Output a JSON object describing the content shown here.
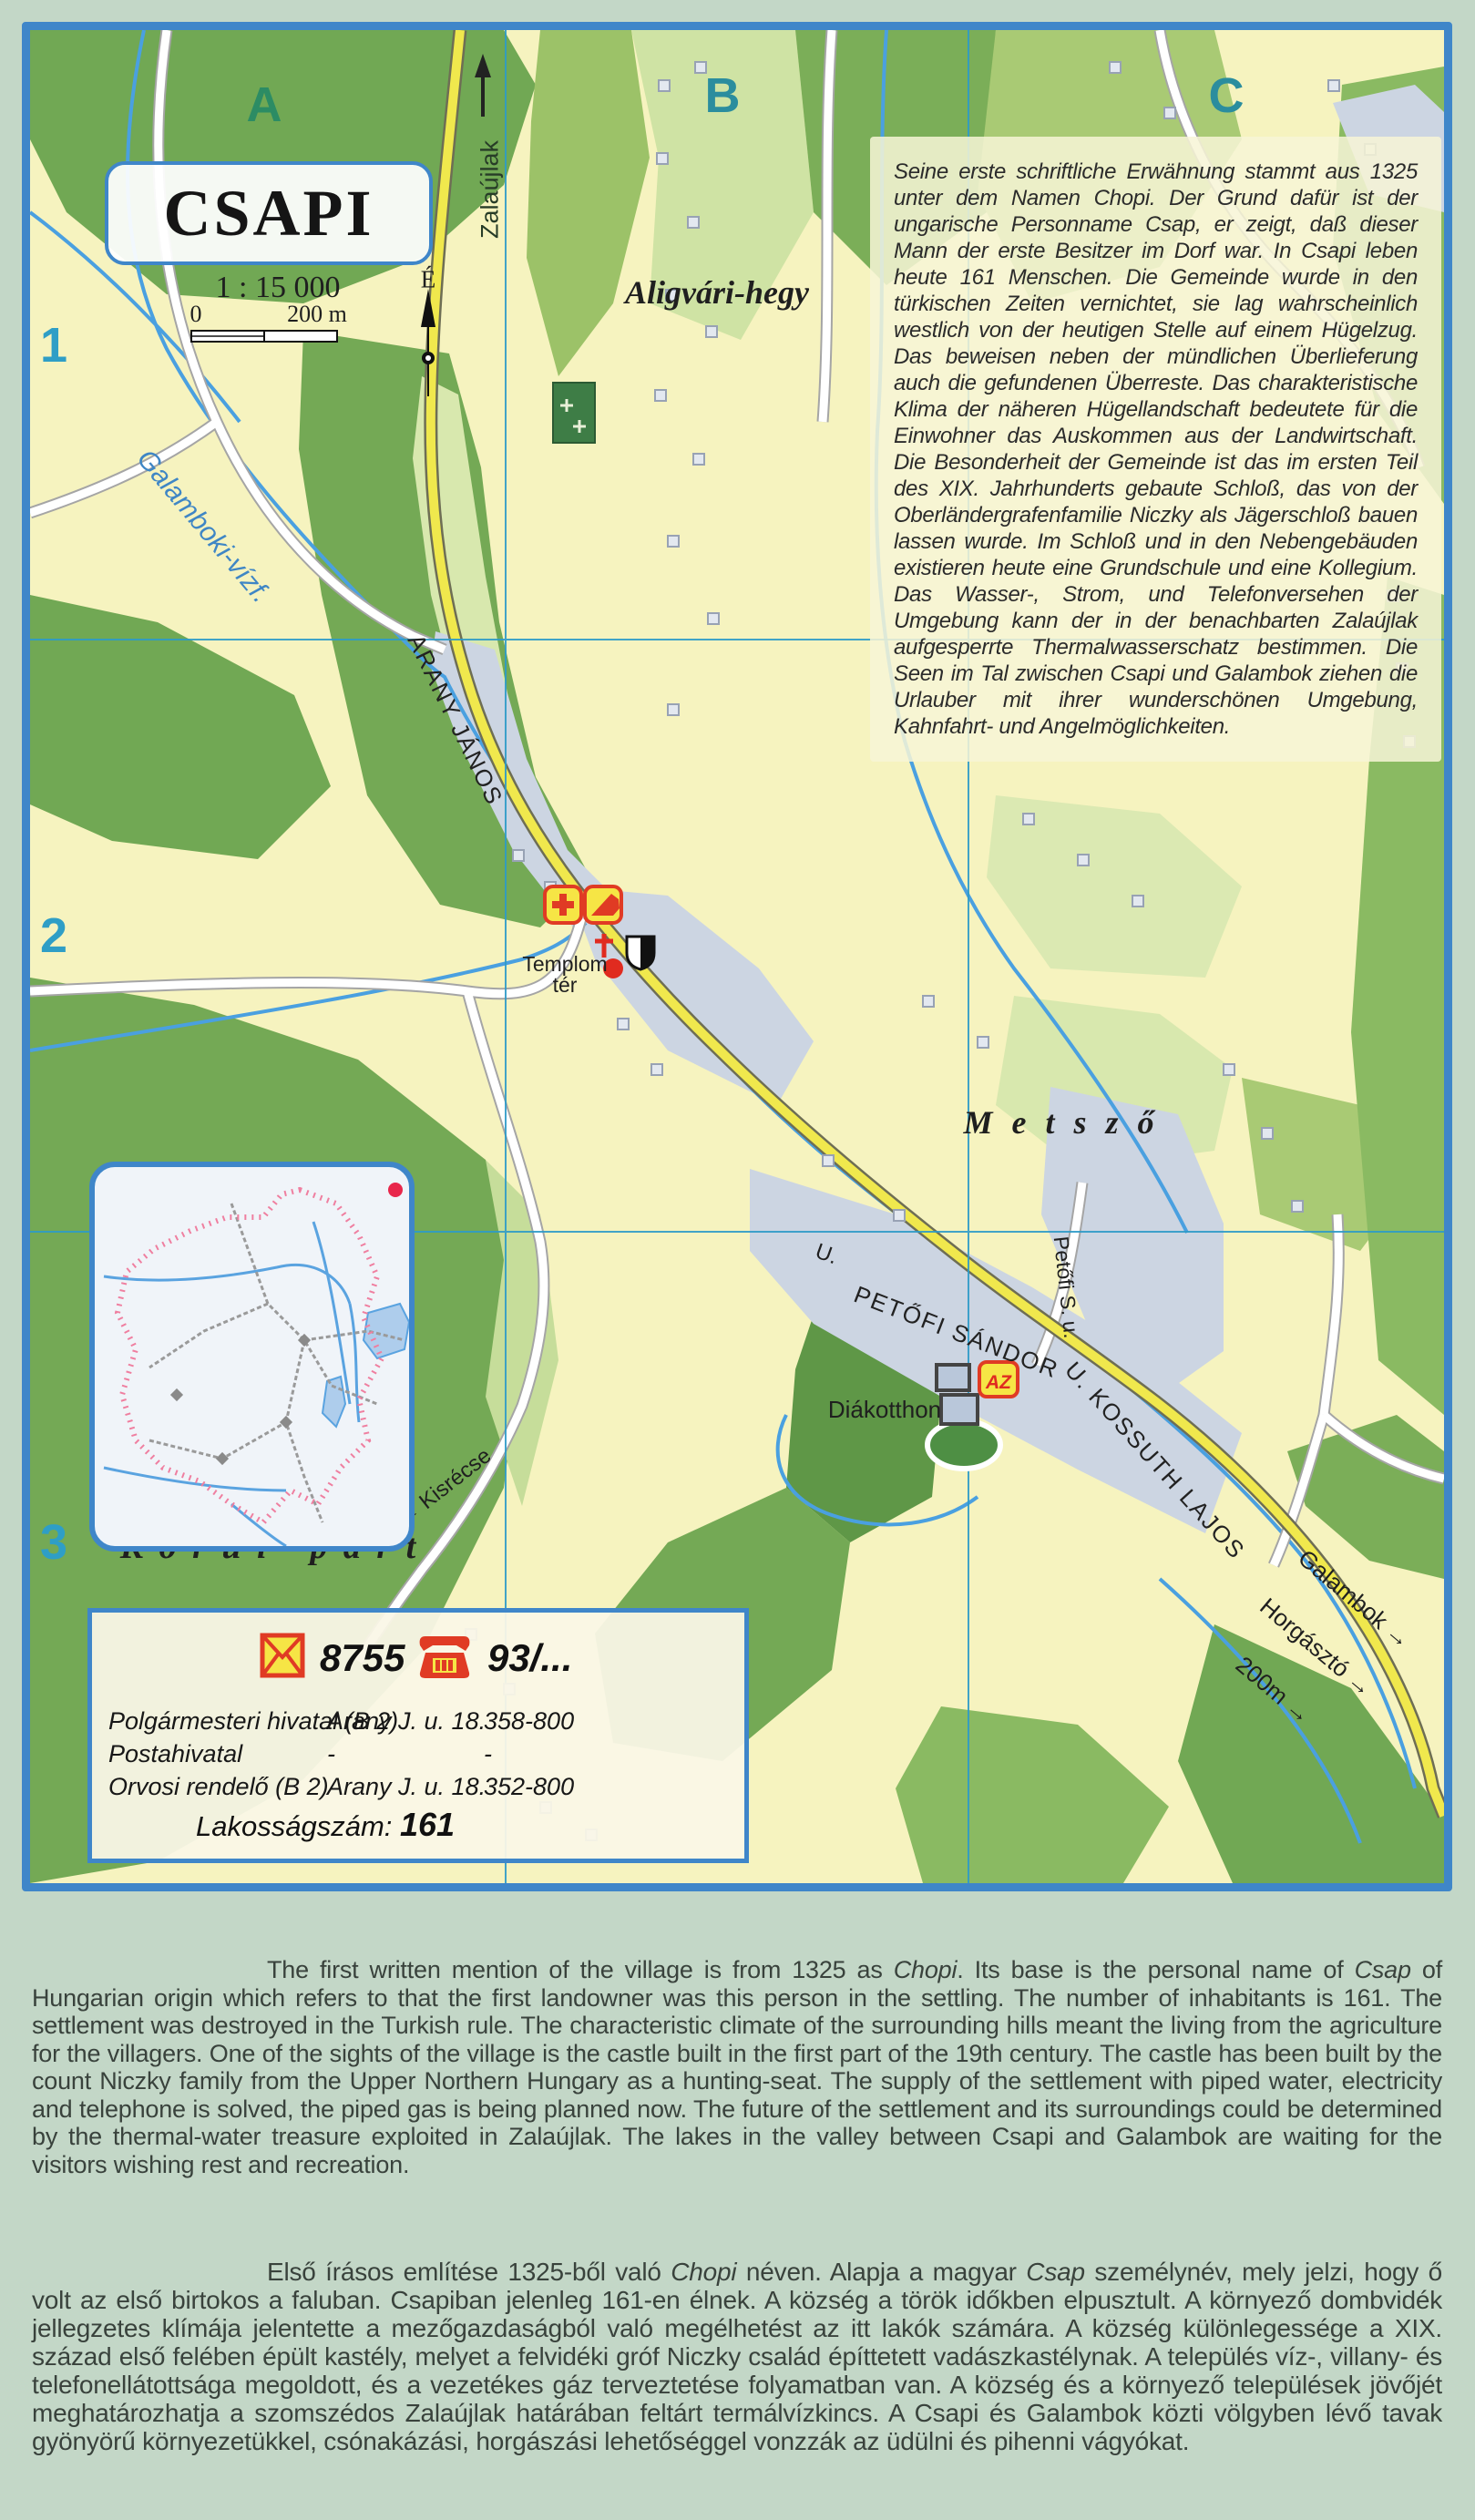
{
  "palette": {
    "map_border_blue": "#3f86c9",
    "map_ground_yellow": "#f6f3bf",
    "forest_dark": "#71a854",
    "forest_mid": "#8aba62",
    "forest_pale": "#d8e8ae",
    "builtup_gray": "#ccd5e2",
    "road_yellow": "#f0e84d",
    "stream_blue": "#4aa0e0",
    "grid_blue": "#2e9bc8",
    "boundary_pink": "#ef7fa0",
    "icon_red": "#e03b24",
    "icon_yellow": "#f6e545",
    "page_bg": "#c3d7c7"
  },
  "map": {
    "title": "CSAPI",
    "scale": {
      "ratio": "1 : 15 000",
      "zero": "0",
      "two_hundred": "200 m"
    },
    "north_label": "É",
    "grid": {
      "columns": [
        "A",
        "B",
        "C"
      ],
      "rows": [
        "1",
        "2",
        "3"
      ]
    },
    "labels": {
      "zalaujlak": "Zalaújlak",
      "aligvari_hegy": "Aligvári-hegy",
      "galamboki": "Galamboki-vízf.",
      "arany_janos": "ARANY JÁNOS",
      "templom_line1": "Templom",
      "templom_line2": "tér",
      "metszo": "M e t s z ő",
      "bozsok_domb": "Bozsok-domb",
      "korul_part": "K ö r ü l - p a r t",
      "diakotthon": "Diákotthon",
      "kisrecse": "← Kisrécse",
      "u_label": "U.",
      "petofi_sandor": "PETŐFI SÁNDOR",
      "kossuth_lajos": "U. KOSSUTH LAJOS",
      "petofi_s_u": "Petőfi S. u.",
      "galambok": "Galambok →",
      "horgaszto": "Horgásztó →",
      "distance_200m": "200m →",
      "az_icon": "AZ"
    },
    "german_text": "Seine erste schriftliche Erwähnung stammt aus 1325 unter dem Namen Chopi. Der Grund dafür ist der ungarische Personname Csap, er zeigt, daß dieser Mann der erste Besitzer im Dorf war. In Csapi leben heute 161 Menschen. Die Gemeinde wurde in den türkischen Zeiten vernichtet, sie lag wahrscheinlich westlich von der heutigen Stelle auf einem Hügelzug. Das beweisen neben der mündlichen Überlieferung auch die gefundenen Überreste. Das charakteristische Klima der näheren Hügellandschaft bedeutete für die Einwohner das Auskommen aus der Landwirtschaft. Die Besonderheit der Gemeinde ist das im ersten Teil des XIX. Jahrhunderts gebaute Schloß, das von der Oberländergrafenfamilie Niczky als Jägerschloß bauen lassen wurde. Im Schloß und in den Nebengebäuden existieren heute eine Grundschule und eine Kollegium. Das Wasser-, Strom, und Telefonversehen der Umgebung kann der in der benachbarten Zalaújlak aufgesperrte Thermalwasserschatz bestimmen. Die Seen im Tal zwischen Csapi und Galambok ziehen die Urlauber mit ihrer wunderschönen Umgebung, Kahnfahrt- und Angelmöglichkeiten.",
    "info_box": {
      "postal_code": "8755",
      "phone_prefix": "93/...",
      "rows": [
        {
          "name": "Polgármesteri hivatal (B 2)",
          "address": "Arany J. u. 18.",
          "phone": "358-800"
        },
        {
          "name": "Postahivatal",
          "address": "-",
          "phone": "-"
        },
        {
          "name": "Orvosi rendelő (B 2)",
          "address": "Arany J. u.  18.",
          "phone": "352-800"
        }
      ],
      "population_label": "Lakosságszám:",
      "population_value": "161"
    }
  },
  "english_paragraph": {
    "segments": [
      {
        "text": "The first written mention of the village is from 1325 as "
      },
      {
        "text": "Chopi",
        "italic": true
      },
      {
        "text": ". Its base is the personal name of "
      },
      {
        "text": "Csap",
        "italic": true
      },
      {
        "text": " of Hungarian origin which refers to that the first landowner was this person in the settling. The number of inhabitants is 161. The settlement was destroyed in the Turkish rule. The characteristic climate of the surrounding hills meant the living from the agriculture for the villagers. One of the sights of the village is the castle built in the first part of the 19th century. The castle has been built by the count Niczky family from the Upper Northern Hungary as a hunting-seat. The supply of the settlement with piped water, electricity and telephone is solved, the piped gas is being planned now. The future of the settlement and its surroundings could be determined by the thermal-water treasure exploited in Zalaújlak. The lakes in the valley between Csapi and Galambok are waiting for the visitors wishing rest and recreation."
      }
    ]
  },
  "hungarian_paragraph": {
    "segments": [
      {
        "text": "Első írásos említése 1325-ből való "
      },
      {
        "text": "Chopi",
        "italic": true
      },
      {
        "text": " néven. Alapja a magyar "
      },
      {
        "text": "Csap",
        "italic": true
      },
      {
        "text": " személynév, mely jelzi, hogy ő volt az első birtokos a faluban. Csapiban jelenleg 161-en élnek. A község a török időkben elpusztult. A környező dombvidék jellegzetes klímája jelentette a mezőgazdaságból való megélhetést az itt lakók számára. A község különlegessége a XIX. század első felében épült kastély, melyet a felvidéki gróf Niczky család építtetett vadászkastélynak. A település víz-, villany- és telefonellátottsága megoldott, és a vezetékes gáz terveztetése folyamatban van. A község és a környező települések jövőjét meghatározhatja a szomszédos Zalaújlak határában feltárt termálvízkincs. A Csapi és Galambok közti völgyben lévő tavak gyönyörű környezetükkel, csónakázási, horgászási lehetőséggel vonzzák az üdülni és pihenni vágyókat."
      }
    ]
  }
}
